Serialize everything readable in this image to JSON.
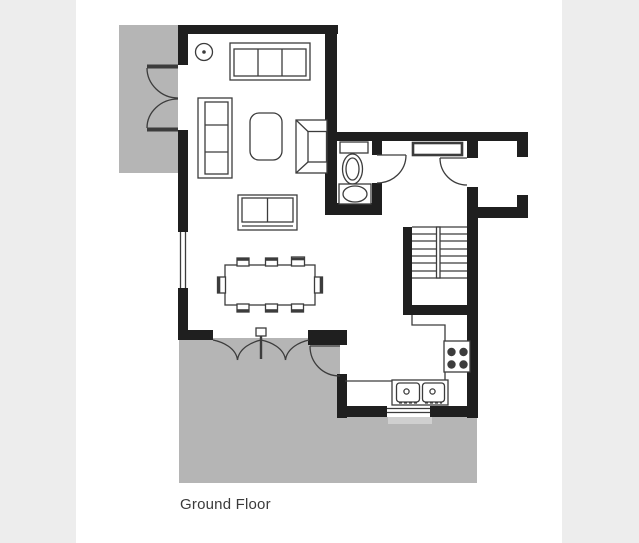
{
  "page": {
    "background": "#ffffff",
    "gutter_color": "#ededed"
  },
  "plan": {
    "label": "Ground Floor",
    "colors": {
      "wall": "#1f1f1f",
      "line": "#3c3c3c",
      "patio": "#b5b5b5",
      "door_step": "#cfcfcf",
      "floor": "#ffffff"
    },
    "features": {
      "areas": [
        "side-patio",
        "rear-patio",
        "door-step"
      ],
      "openings": [
        "french-doors",
        "bifold-doors",
        "patio-door",
        "front-door",
        "wc-door",
        "entrance-opening",
        "window-left",
        "window-kitchen"
      ],
      "fixtures": [
        "toilet",
        "wash-basin",
        "radiator",
        "staircase",
        "hob",
        "double-sink",
        "ceiling-light"
      ],
      "furniture": [
        "sofa-3-seat",
        "sofa-side",
        "loveseat",
        "coffee-table",
        "armchair",
        "dining-table",
        "dining-chairs"
      ]
    }
  }
}
